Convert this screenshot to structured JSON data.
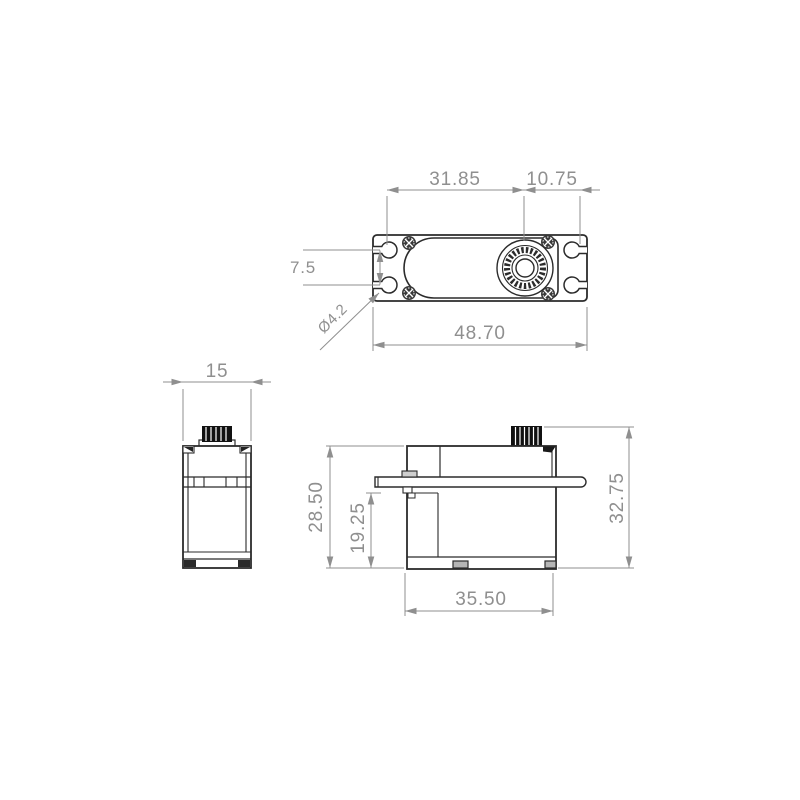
{
  "meta": {
    "drawing_type": "technical dimension drawing",
    "subject": "RC servo motor outline (3 orthographic views)",
    "line_color": "#2b2b2b",
    "dimension_color": "#8f8f8f",
    "background": "#ffffff"
  },
  "views": {
    "top": {
      "name": "top-view",
      "dims": {
        "hole_to_shaft": "31.85",
        "shaft_to_hole": "10.75",
        "flange_hole_pitch": "7.5",
        "hole_diameter": "Ø4.2",
        "overall_length": "48.70"
      }
    },
    "side": {
      "name": "side-view",
      "dims": {
        "body_width": "15"
      }
    },
    "front": {
      "name": "front-view",
      "dims": {
        "body_height": "28.50",
        "flange_to_base": "19.25",
        "overall_height": "32.75",
        "case_length": "35.50"
      }
    }
  }
}
